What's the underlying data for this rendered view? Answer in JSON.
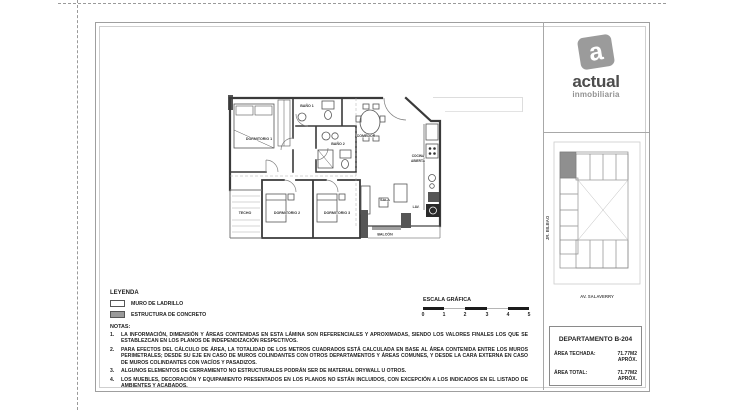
{
  "brand": {
    "logo_letter": "a",
    "name": "actual",
    "subtitle": "inmobiliaria"
  },
  "legend": {
    "title": "LEYENDA",
    "items": [
      {
        "label": "MURO DE LADRILLO"
      },
      {
        "label": "ESTRUCTURA DE CONCRETO"
      }
    ]
  },
  "notes": {
    "title": "NOTAS:",
    "items": [
      {
        "num": "1.",
        "text": "LA INFORMACIÓN, DIMENSIÓN Y ÁREAS CONTENIDAS EN ESTA LÁMINA SON REFERENCIALES Y APROXIMADAS, SIENDO LOS VALORES FINALES LOS QUE SE ESTABLEZCAN EN LOS PLANOS DE INDEPENDIZACIÓN RESPECTIVOS."
      },
      {
        "num": "2.",
        "text": "PARA EFECTOS DEL CÁLCULO DE ÁREA, LA TOTALIDAD DE LOS METROS CUADRADOS ESTÁ CALCULADA EN BASE AL ÁREA CONTENIDA ENTRE LOS MUROS PERIMETRALES; DESDE SU EJE EN CASO DE MUROS COLINDANTES CON OTROS DEPARTAMENTOS Y ÁREAS COMUNES, Y DESDE LA CARA EXTERNA EN CASO DE MUROS COLINDANTES CON VACÍOS Y PASADIZOS."
      },
      {
        "num": "3.",
        "text": "ALGUNOS ELEMENTOS DE CERRAMIENTO NO ESTRUCTURALES PODRÁN SER DE MATERIAL DRYWALL U OTROS."
      },
      {
        "num": "4.",
        "text": "LOS MUEBLES, DECORACIÓN Y EQUIPAMIENTO PRESENTADOS EN LOS PLANOS NO ESTÁN INCLUIDOS, CON EXCEPCIÓN A LOS INDICADOS EN EL LISTADO DE AMBIENTES Y ACABADOS."
      }
    ]
  },
  "scale_bar": {
    "title": "ESCALA GRÁFICA",
    "ticks": [
      "0",
      "1",
      "2",
      "3",
      "4",
      "5"
    ]
  },
  "title_block": {
    "title": "DEPARTAMENTO B-204",
    "rows": [
      {
        "label": "ÁREA TECHADA:",
        "value": "71.77M2 APRÓX."
      },
      {
        "label": "ÁREA TOTAL:",
        "value": "71.77M2 APRÓX."
      }
    ]
  },
  "site_map": {
    "street_left": "JR. BILBAO",
    "street_bottom": "AV. SALAVERRY"
  },
  "floor_plan": {
    "rooms": {
      "dormitorio1": "DORMITORIO 1",
      "bano1": "BAÑO 1",
      "bano2": "BAÑO 2",
      "comedor": "COMEDOR",
      "cocina_line1": "COCINA",
      "cocina_line2": "ABIERTA",
      "sala": "SALA",
      "lav": "LAV.",
      "dormitorio2": "DORMITORIO 2",
      "dormitorio3": "DORMITORIO 3",
      "techo": "TECHO",
      "balcon": "BALCÓN"
    }
  },
  "colors": {
    "logo_gray": "#9b9b9b",
    "concrete_gray": "#9a9a9a",
    "wall_dark": "#3a3a3a"
  }
}
